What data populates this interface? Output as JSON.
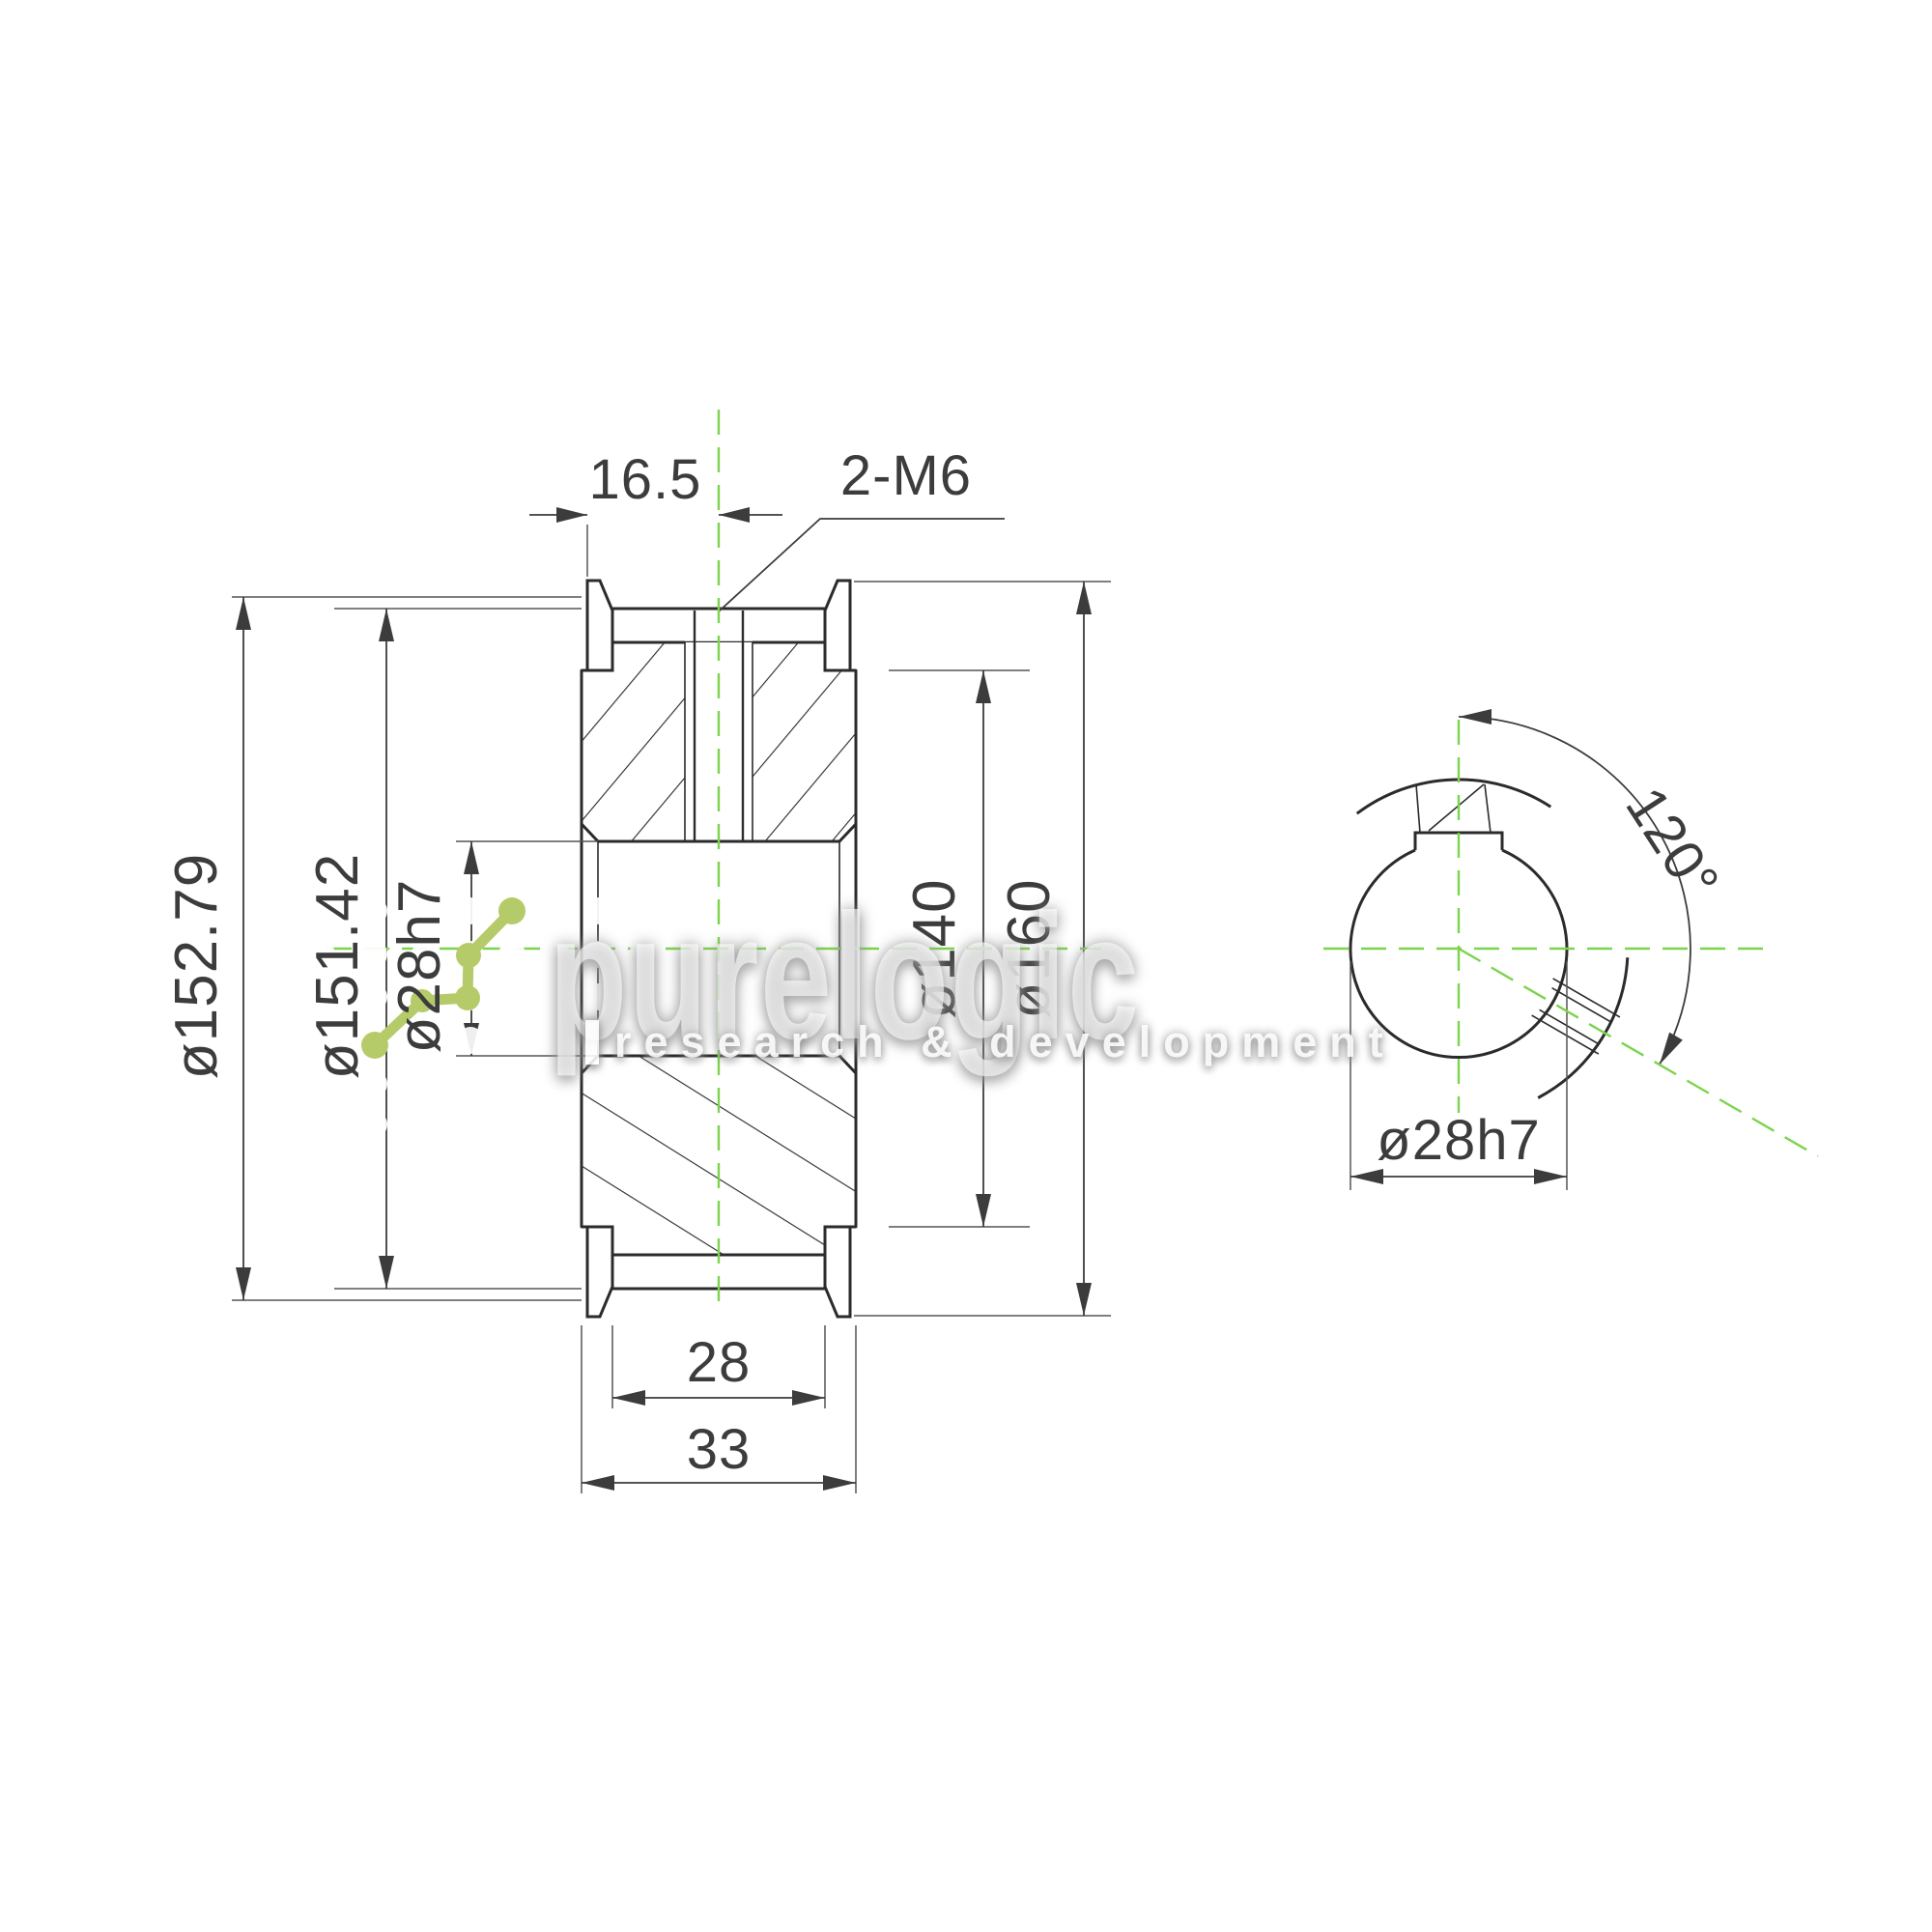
{
  "page": {
    "background": "#ffffff",
    "type": "technical drawing, timing belt pulley, section view and end view"
  },
  "colors": {
    "line": "#2b2b2b",
    "dimension": "#3c3c3c",
    "centerline_green": "#7cd44d",
    "logo_green": "#b5cb69"
  },
  "main_view": {
    "dim_face_to_hole": "16.5",
    "dim_holes_callout": "2-M6",
    "dim_pitch_diameter": "ø152.79",
    "dim_outside_diameter": "ø151.42",
    "dim_bore_diameter": "ø28h7",
    "dim_root_diameter": "ø140",
    "dim_flange_diameter": "ø160",
    "dim_belt_width": "28",
    "dim_overall_width": "33"
  },
  "end_view": {
    "dim_bore_diameter": "ø28h7",
    "dim_holes_angle": "120°"
  },
  "watermark": {
    "brand": "purelogic",
    "tagline": "research & development"
  }
}
